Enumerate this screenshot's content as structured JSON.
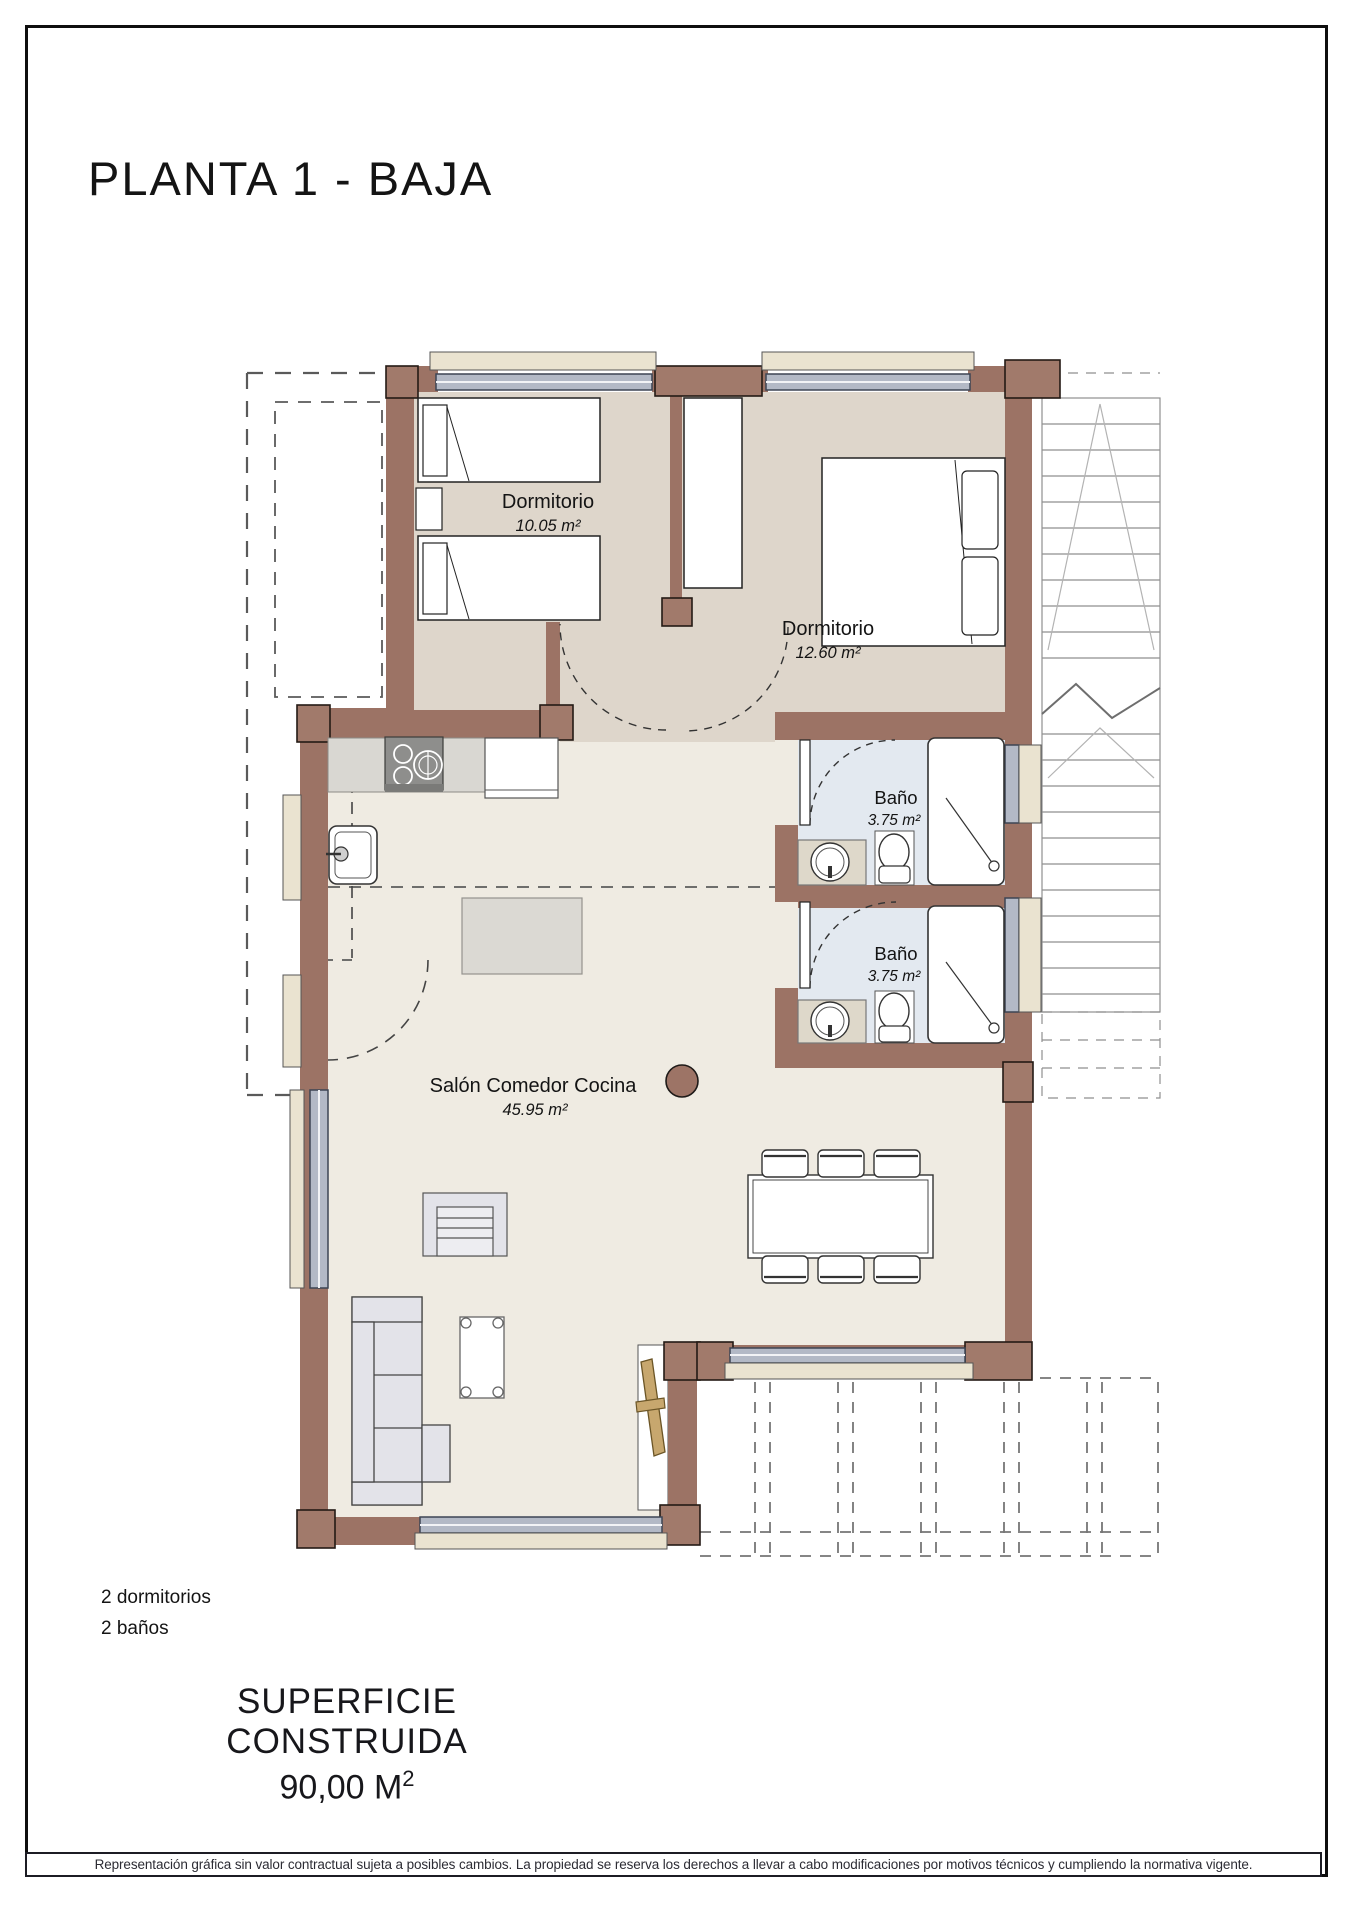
{
  "title": "PLANTA 1 - BAJA",
  "rooms": {
    "bedroom1": {
      "name": "Dormitorio",
      "area": "10.05 m²"
    },
    "bedroom2": {
      "name": "Dormitorio",
      "area": "12.60 m²"
    },
    "bath1": {
      "name": "Baño",
      "area": "3.75 m²"
    },
    "bath2": {
      "name": "Baño",
      "area": "3.75 m²"
    },
    "living": {
      "name": "Salón Comedor Cocina",
      "area": "45.95 m²"
    }
  },
  "summary": {
    "bedrooms": "2 dormitorios",
    "bathrooms": "2 baños"
  },
  "built_area": {
    "label": "SUPERFICIE CONSTRUIDA",
    "value": "90,00 M",
    "sup": "2"
  },
  "disclaimer": "Representación gráfica sin valor contractual sujeta a posibles cambios. La propiedad se reserva los derechos a llevar a cabo modificaciones por motivos técnicos y cumpliendo la normativa vigente.",
  "colors": {
    "wall": "#9c7365",
    "bedroom_floor": "#ded6cb",
    "living_floor": "#efebe2",
    "bath_floor": "#e3e9f0",
    "window_frame": "#b3b9c6",
    "sill": "#eae3d0",
    "wood_door": "#c7a76e"
  }
}
